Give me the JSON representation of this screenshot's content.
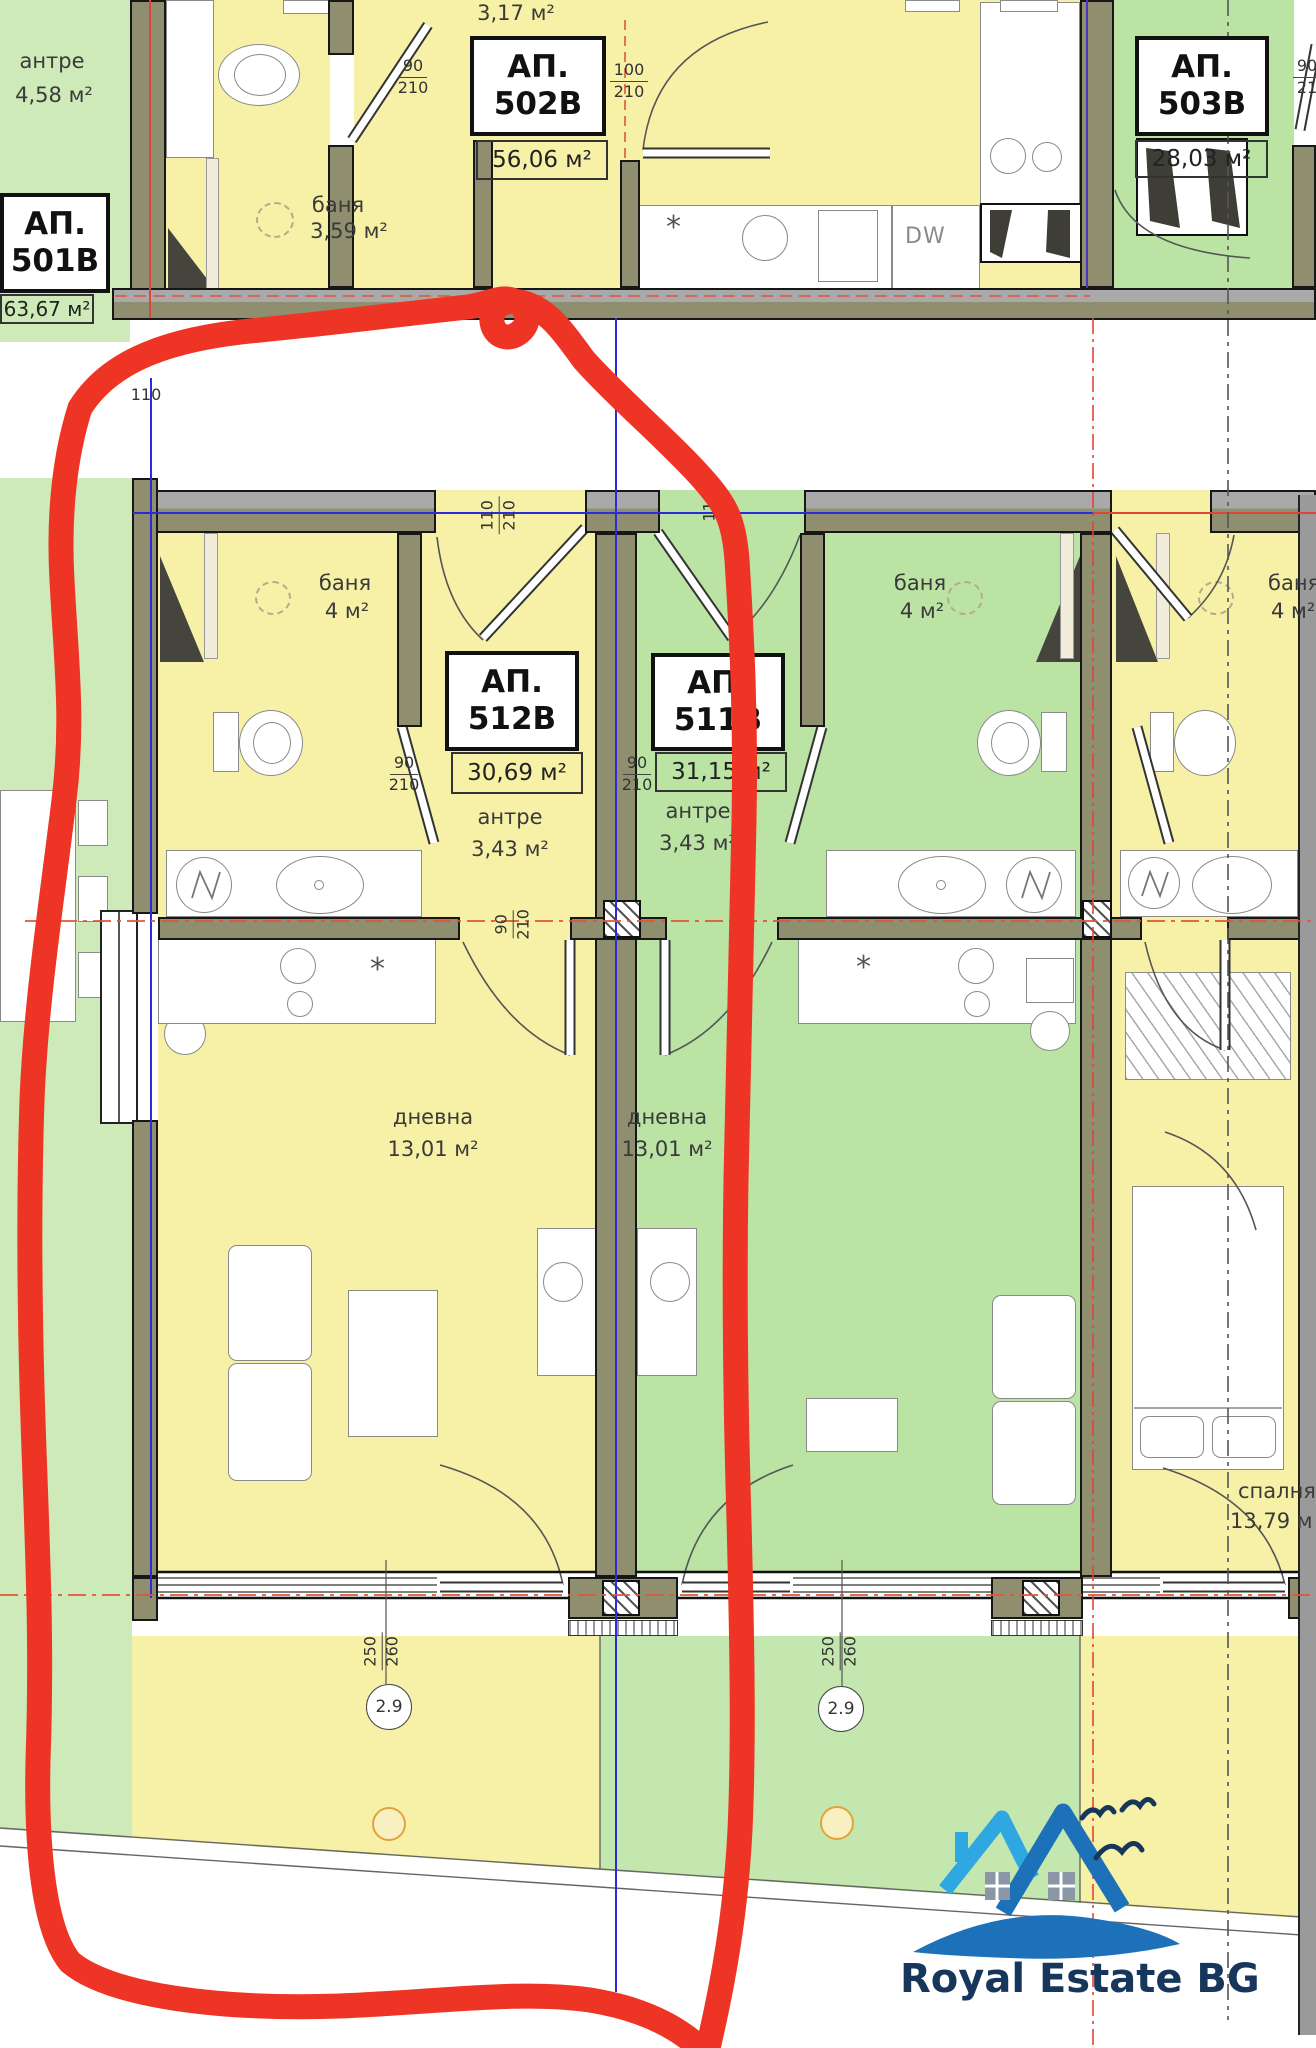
{
  "apartments": {
    "a501": {
      "code": "АП.",
      "number": "501В",
      "area": "63,67 м²",
      "antre_name": "антре",
      "antre_area": "4,58 м²"
    },
    "a502": {
      "code": "АП.",
      "number": "502В",
      "area": "56,06 м²",
      "bath_name": "баня",
      "bath_area": "3,59 м²",
      "closet_area": "3,17 м²"
    },
    "a503": {
      "code": "АП.",
      "number": "503В",
      "area": "28,03 м²"
    },
    "a512": {
      "code": "АП.",
      "number": "512В",
      "area": "30,69 м²",
      "antre_name": "антре",
      "antre_area": "3,43 м²",
      "bath_name": "баня",
      "bath_area": "4 м²",
      "living_name": "дневна",
      "living_area": "13,01 м²"
    },
    "a511": {
      "code": "АП.",
      "number": "511В",
      "area": "31,15 м²",
      "antre_name": "антре",
      "antre_area": "3,43 м²",
      "bath_name": "баня",
      "bath_area": "4 м²",
      "living_name": "дневна",
      "living_area": "13,01 м²"
    },
    "a513": {
      "bath_name": "баня",
      "bath_area": "4 м²",
      "bedroom_name": "спалня",
      "bedroom_area": "13,79 м"
    }
  },
  "dimensions": {
    "door90": {
      "num": "90",
      "den": "210"
    },
    "door100": {
      "num": "100",
      "den": "210"
    },
    "door110": {
      "num": "110",
      "den": "210"
    },
    "wall110": "110",
    "win250": {
      "num": "250",
      "den": "260"
    },
    "level": "2.9",
    "cut90": "90",
    "cut21": "21"
  },
  "labels": {
    "dw": "DW",
    "star": "*"
  },
  "logo": {
    "text": "Royal Estate BG",
    "navy": "#16365c",
    "blue": "#1d71b8",
    "light_blue": "#2fa8e1"
  },
  "colors": {
    "room_yellow": "#f6f1a6",
    "room_green": "#bae3a4",
    "strip_green": "#cdeab8",
    "terrace_green": "#c3e7ae",
    "wall_olive": "#8f8f70",
    "marker_red": "#ee3425",
    "axis_blue": "#2b2bd8",
    "axis_red": "#e04436"
  }
}
